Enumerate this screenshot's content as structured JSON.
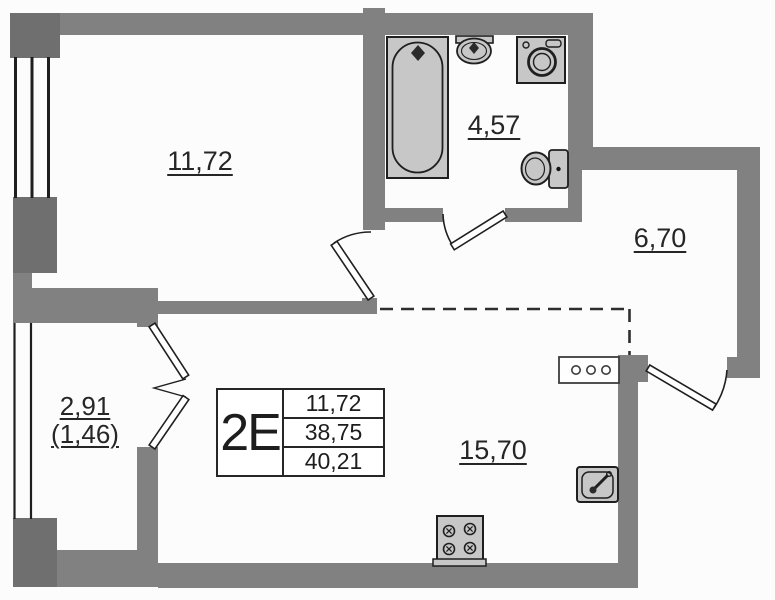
{
  "plan": {
    "title": "apartment-floor-plan",
    "rooms": [
      {
        "name": "bedroom",
        "area": "11,72"
      },
      {
        "name": "bathroom",
        "area": "4,57"
      },
      {
        "name": "hallway",
        "area": "6,70"
      },
      {
        "name": "kitchen-living",
        "area": "15,70"
      },
      {
        "name": "balcony",
        "area": "2,91",
        "area_coefficient": "(1,46)"
      }
    ],
    "info_box": {
      "apartment_type": "2Е",
      "rows": [
        "11,72",
        "38,75",
        "40,21"
      ]
    },
    "fixtures": [
      "bathtub-icon",
      "bath-sink-icon",
      "washing-machine-icon",
      "toilet-icon",
      "kitchen-sink-icon",
      "stove-icon",
      "electrical-panel-icon"
    ],
    "colors": {
      "wall": "#818181",
      "fixture_fill": "#c7c7c7",
      "line": "#1f1f1f",
      "background": "#fcfcfc"
    }
  }
}
